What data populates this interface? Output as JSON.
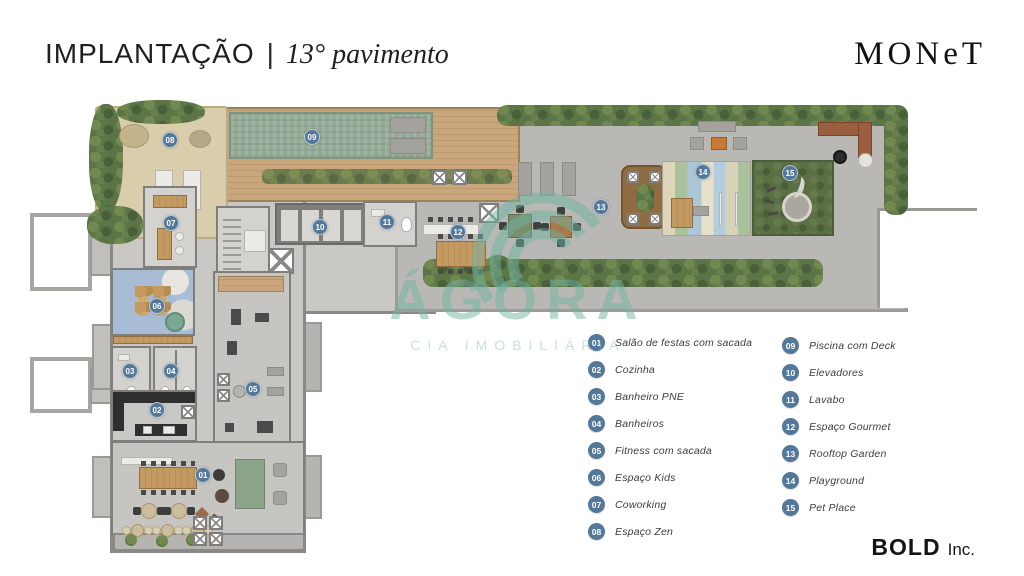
{
  "header": {
    "title": "IMPLANTAÇÃO",
    "separator": "|",
    "subtitle": "13° pavimento",
    "brand": "MONeT"
  },
  "watermark": {
    "brand": "ÁGORA",
    "tagline": "CIA IMOBILIÁRIA"
  },
  "legend": {
    "items": [
      {
        "num": "01",
        "label": "Salão de festas com sacada"
      },
      {
        "num": "02",
        "label": "Cozinha"
      },
      {
        "num": "03",
        "label": "Banheiro PNE"
      },
      {
        "num": "04",
        "label": "Banheiros"
      },
      {
        "num": "05",
        "label": "Fitness com sacada"
      },
      {
        "num": "06",
        "label": "Espaço Kids"
      },
      {
        "num": "07",
        "label": "Coworking"
      },
      {
        "num": "08",
        "label": "Espaço Zen"
      },
      {
        "num": "09",
        "label": "Piscina com Deck"
      },
      {
        "num": "10",
        "label": "Elevadores"
      },
      {
        "num": "11",
        "label": "Lavabo"
      },
      {
        "num": "12",
        "label": "Espaço Gourmet"
      },
      {
        "num": "13",
        "label": "Rooftop Garden"
      },
      {
        "num": "14",
        "label": "Playground"
      },
      {
        "num": "15",
        "label": "Pet Place"
      }
    ]
  },
  "footer": {
    "brand": "BOLD",
    "suffix": "Inc."
  },
  "colors": {
    "badge": "#54789a",
    "watermark": "#6fb3a1",
    "pool": "#94aa97",
    "hedge": "#5c7547",
    "deck": "#c9a67b",
    "pet_grass": "#5a6f44"
  }
}
